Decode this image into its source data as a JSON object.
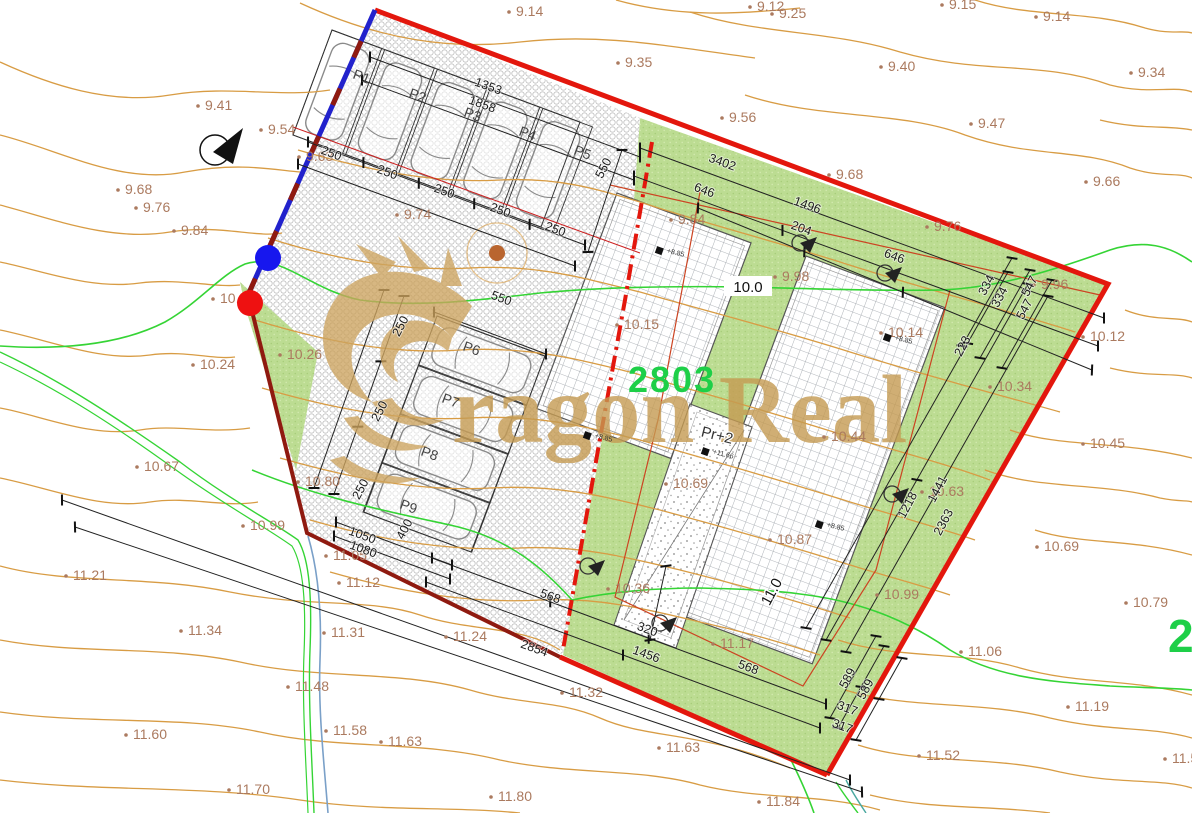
{
  "watermark": {
    "text": "ragon Real",
    "logo": "dragon-head"
  },
  "parcel": {
    "number": "2803",
    "adjacent_number_partial": "2",
    "building_code": "Pr+2"
  },
  "level_chips": [
    {
      "text": "10.0",
      "x": 748,
      "y": 292,
      "rot": 0
    },
    {
      "text": "11.0",
      "x": 776,
      "y": 594,
      "rot": -62
    }
  ],
  "parking_labels": [
    {
      "text": "P1",
      "x": 352,
      "y": 78,
      "rot": 20
    },
    {
      "text": "P2",
      "x": 408,
      "y": 97,
      "rot": 20
    },
    {
      "text": "P3",
      "x": 463,
      "y": 116,
      "rot": 20
    },
    {
      "text": "P4",
      "x": 518,
      "y": 135,
      "rot": 20
    },
    {
      "text": "P5",
      "x": 573,
      "y": 154,
      "rot": 20
    },
    {
      "text": "P6",
      "x": 462,
      "y": 350,
      "rot": 20
    },
    {
      "text": "P7",
      "x": 441,
      "y": 402,
      "rot": 20
    },
    {
      "text": "P8",
      "x": 420,
      "y": 455,
      "rot": 20
    },
    {
      "text": "P9",
      "x": 399,
      "y": 508,
      "rot": 20
    }
  ],
  "dimension_labels": [
    {
      "text": "250",
      "x": 330,
      "y": 157,
      "rot": 20
    },
    {
      "text": "250",
      "x": 386,
      "y": 176,
      "rot": 20
    },
    {
      "text": "250",
      "x": 443,
      "y": 195,
      "rot": 20
    },
    {
      "text": "250",
      "x": 499,
      "y": 214,
      "rot": 20
    },
    {
      "text": "250",
      "x": 554,
      "y": 233,
      "rot": 20
    },
    {
      "text": "1353",
      "x": 487,
      "y": 90,
      "rot": 20
    },
    {
      "text": "1858",
      "x": 481,
      "y": 108,
      "rot": 20
    },
    {
      "text": "550",
      "x": 607,
      "y": 170,
      "rot": -62
    },
    {
      "text": "3402",
      "x": 721,
      "y": 166,
      "rot": 20
    },
    {
      "text": "646",
      "x": 703,
      "y": 194,
      "rot": 20
    },
    {
      "text": "1496",
      "x": 806,
      "y": 209,
      "rot": 20
    },
    {
      "text": "204",
      "x": 800,
      "y": 232,
      "rot": 20
    },
    {
      "text": "646",
      "x": 893,
      "y": 260,
      "rot": 20
    },
    {
      "text": "334",
      "x": 990,
      "y": 287,
      "rot": -62
    },
    {
      "text": "334",
      "x": 1003,
      "y": 299,
      "rot": -62
    },
    {
      "text": "547",
      "x": 1033,
      "y": 288,
      "rot": -62
    },
    {
      "text": "547",
      "x": 1028,
      "y": 311,
      "rot": -62
    },
    {
      "text": "223",
      "x": 966,
      "y": 348,
      "rot": -62
    },
    {
      "text": "1441",
      "x": 941,
      "y": 491,
      "rot": -62
    },
    {
      "text": "1218",
      "x": 911,
      "y": 507,
      "rot": -62
    },
    {
      "text": "2363",
      "x": 947,
      "y": 524,
      "rot": -62
    },
    {
      "text": "550",
      "x": 500,
      "y": 302,
      "rot": 20
    },
    {
      "text": "250",
      "x": 404,
      "y": 328,
      "rot": -62
    },
    {
      "text": "250",
      "x": 383,
      "y": 413,
      "rot": -62
    },
    {
      "text": "250",
      "x": 364,
      "y": 491,
      "rot": -62
    },
    {
      "text": "400",
      "x": 408,
      "y": 531,
      "rot": -62
    },
    {
      "text": "1050",
      "x": 361,
      "y": 539,
      "rot": 20
    },
    {
      "text": "1080",
      "x": 362,
      "y": 553,
      "rot": 20
    },
    {
      "text": "568",
      "x": 549,
      "y": 600,
      "rot": 20
    },
    {
      "text": "320",
      "x": 646,
      "y": 633,
      "rot": 20
    },
    {
      "text": "1456",
      "x": 645,
      "y": 658,
      "rot": 20
    },
    {
      "text": "568",
      "x": 747,
      "y": 671,
      "rot": 20
    },
    {
      "text": "589",
      "x": 851,
      "y": 680,
      "rot": -62
    },
    {
      "text": "589",
      "x": 869,
      "y": 691,
      "rot": -62
    },
    {
      "text": "317",
      "x": 846,
      "y": 712,
      "rot": 20
    },
    {
      "text": "317",
      "x": 841,
      "y": 730,
      "rot": 20
    },
    {
      "text": "2854",
      "x": 533,
      "y": 652,
      "rot": 20
    }
  ],
  "contour_labels": [
    {
      "text": "9.12",
      "x": 757,
      "y": 11
    },
    {
      "text": "9.15",
      "x": 949,
      "y": 9
    },
    {
      "text": "9.14",
      "x": 516,
      "y": 16
    },
    {
      "text": "9.25",
      "x": 779,
      "y": 18
    },
    {
      "text": "9.14",
      "x": 1043,
      "y": 21
    },
    {
      "text": "9.35",
      "x": 625,
      "y": 67
    },
    {
      "text": "9.40",
      "x": 888,
      "y": 71
    },
    {
      "text": "9.34",
      "x": 1138,
      "y": 77
    },
    {
      "text": "9.41",
      "x": 205,
      "y": 110
    },
    {
      "text": "9.56",
      "x": 729,
      "y": 122
    },
    {
      "text": "9.47",
      "x": 978,
      "y": 128
    },
    {
      "text": "9.54",
      "x": 268,
      "y": 134
    },
    {
      "text": "9.68",
      "x": 125,
      "y": 194
    },
    {
      "text": "9.76",
      "x": 143,
      "y": 212
    },
    {
      "text": "9.84",
      "x": 181,
      "y": 235
    },
    {
      "text": "9.63",
      "x": 306,
      "y": 161
    },
    {
      "text": "9.74",
      "x": 404,
      "y": 219
    },
    {
      "text": "9.84",
      "x": 678,
      "y": 224
    },
    {
      "text": "9.68",
      "x": 836,
      "y": 179
    },
    {
      "text": "9.76",
      "x": 934,
      "y": 231
    },
    {
      "text": "9.66",
      "x": 1093,
      "y": 186
    },
    {
      "text": "9.96",
      "x": 1041,
      "y": 289
    },
    {
      "text": "9.98",
      "x": 782,
      "y": 281
    },
    {
      "text": "10.08",
      "x": 220,
      "y": 303
    },
    {
      "text": "10.12",
      "x": 1090,
      "y": 341
    },
    {
      "text": "10.14",
      "x": 888,
      "y": 337
    },
    {
      "text": "10.15",
      "x": 624,
      "y": 329
    },
    {
      "text": "10.24",
      "x": 200,
      "y": 369
    },
    {
      "text": "10.26",
      "x": 287,
      "y": 359
    },
    {
      "text": "10.34",
      "x": 997,
      "y": 391
    },
    {
      "text": "10.44",
      "x": 831,
      "y": 441
    },
    {
      "text": "10.45",
      "x": 1090,
      "y": 448
    },
    {
      "text": "10.36",
      "x": 615,
      "y": 593
    },
    {
      "text": "10.63",
      "x": 929,
      "y": 496
    },
    {
      "text": "10.67",
      "x": 144,
      "y": 471
    },
    {
      "text": "10.69",
      "x": 673,
      "y": 488
    },
    {
      "text": "10.69",
      "x": 1044,
      "y": 551
    },
    {
      "text": "10.79",
      "x": 1133,
      "y": 607
    },
    {
      "text": "10.80",
      "x": 305,
      "y": 486
    },
    {
      "text": "10.87",
      "x": 777,
      "y": 544
    },
    {
      "text": "10.99",
      "x": 250,
      "y": 530
    },
    {
      "text": "10.99",
      "x": 884,
      "y": 599
    },
    {
      "text": "11.05",
      "x": 333,
      "y": 560
    },
    {
      "text": "11.06",
      "x": 968,
      "y": 656
    },
    {
      "text": "11.12",
      "x": 346,
      "y": 587
    },
    {
      "text": "11.17",
      "x": 720,
      "y": 648
    },
    {
      "text": "11.19",
      "x": 1075,
      "y": 711
    },
    {
      "text": "11.21",
      "x": 73,
      "y": 580
    },
    {
      "text": "11.24",
      "x": 453,
      "y": 641
    },
    {
      "text": "11.31",
      "x": 331,
      "y": 637
    },
    {
      "text": "11.32",
      "x": 569,
      "y": 697
    },
    {
      "text": "11.34",
      "x": 188,
      "y": 635
    },
    {
      "text": "11.48",
      "x": 295,
      "y": 691
    },
    {
      "text": "11.52",
      "x": 926,
      "y": 760
    },
    {
      "text": "11.52",
      "x": 1172,
      "y": 763
    },
    {
      "text": "11.58",
      "x": 333,
      "y": 735
    },
    {
      "text": "11.60",
      "x": 133,
      "y": 739
    },
    {
      "text": "11.63",
      "x": 388,
      "y": 746
    },
    {
      "text": "11.63",
      "x": 666,
      "y": 752
    },
    {
      "text": "11.70",
      "x": 236,
      "y": 794
    },
    {
      "text": "11.80",
      "x": 498,
      "y": 801
    },
    {
      "text": "11.84",
      "x": 766,
      "y": 806
    }
  ],
  "spot_elevations": [
    {
      "text": "+8.85",
      "x": 668,
      "y": 255
    },
    {
      "text": "+8.85",
      "x": 596,
      "y": 440
    },
    {
      "text": "+11.66",
      "x": 714,
      "y": 456
    },
    {
      "text": "+8.85",
      "x": 828,
      "y": 529
    },
    {
      "text": "+8.85",
      "x": 896,
      "y": 342
    }
  ],
  "colors": {
    "boundary_red": "#e3170d",
    "boundary_dark_red": "#8f1a10",
    "boundary_blue": "#2222cc",
    "contour_orange": "#d89c44",
    "contour_label_brown": "#ab7a5f",
    "green_area": "#bcdc92",
    "bright_green_contour": "#35d435",
    "parcel_number_green": "#1ecf48",
    "watermark_gold": "#c59b52",
    "stream_blue": "#7aa0c8"
  }
}
